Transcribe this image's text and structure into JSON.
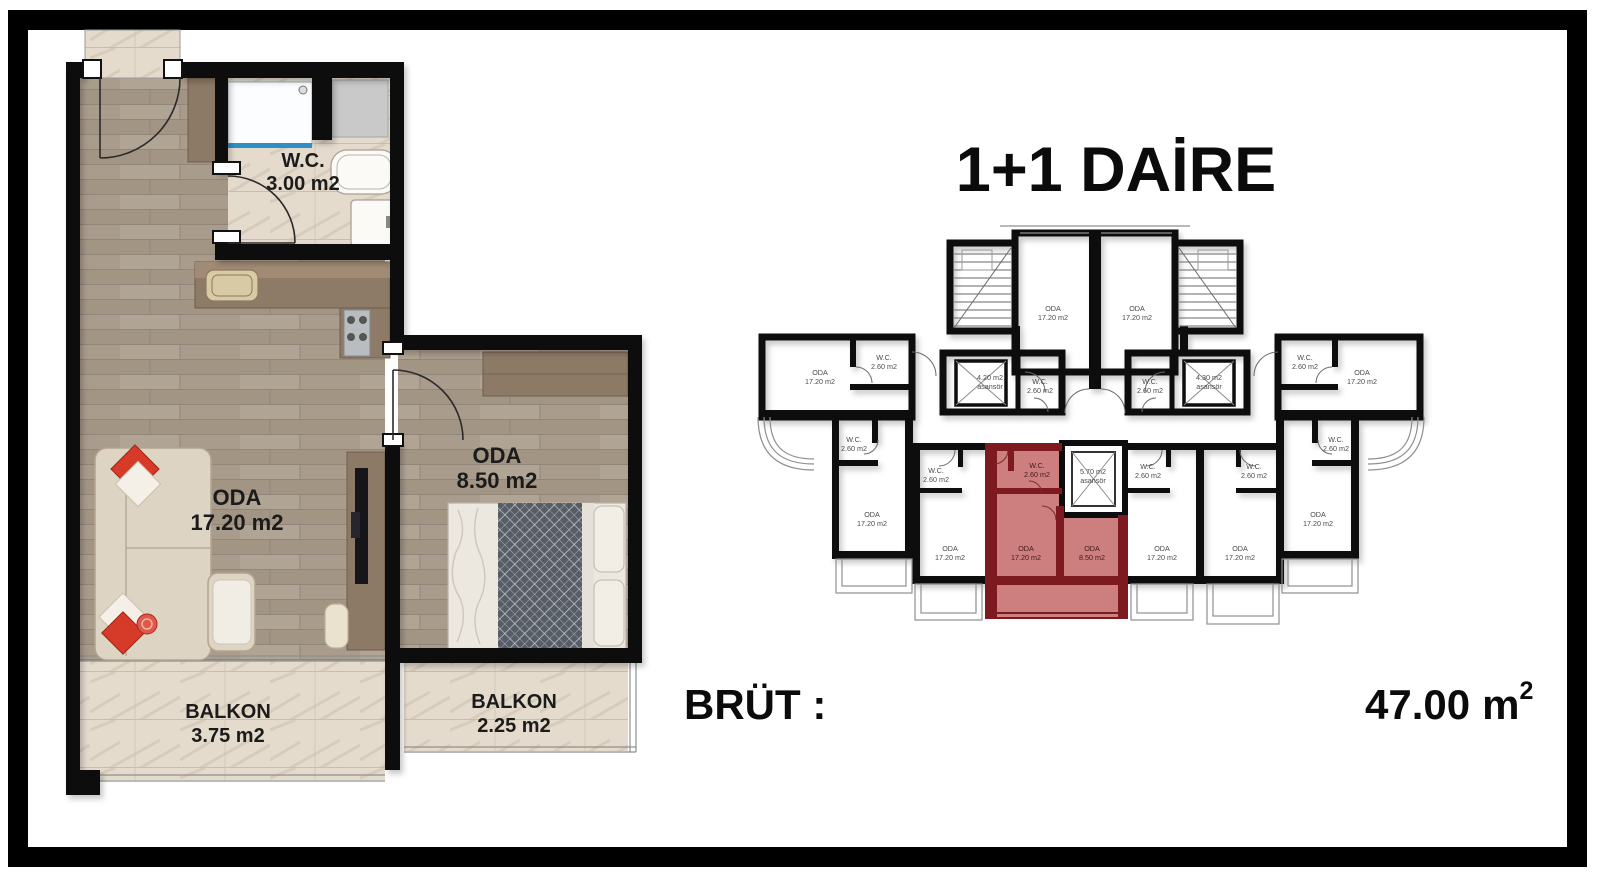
{
  "title": "1+1 DAİRE",
  "summary": {
    "label": "BRÜT :",
    "value": "47.00",
    "unit": "m",
    "sup": "2"
  },
  "colors": {
    "wall": "#0d0d0d",
    "highlight": "#c4686a",
    "highlight_wall": "#7c1a1f",
    "wood": "#a99c8c",
    "marble": "#e4dbcd",
    "cabinet": "#8d7a66"
  },
  "detail_plan": {
    "living": {
      "name": "ODA",
      "area": "17.20 m2"
    },
    "bedroom": {
      "name": "ODA",
      "area": "8.50 m2"
    },
    "wc": {
      "name": "W.C.",
      "area": "3.00 m2"
    },
    "balcony_left": {
      "name": "BALKON",
      "area": "3.75 m2"
    },
    "balcony_right": {
      "name": "BALKON",
      "area": "2.25 m2"
    }
  },
  "key_plan": {
    "room": "ODA",
    "room_area": "17.20 m2",
    "small_room_area": "8.50 m2",
    "wc": "W.C.",
    "wc_area": "2.60 m2",
    "elevator_left": "4.20 m2",
    "elevator_right": "4.30 m2",
    "elevator_center": "5.70 m2",
    "elevator_word": "asansör"
  }
}
